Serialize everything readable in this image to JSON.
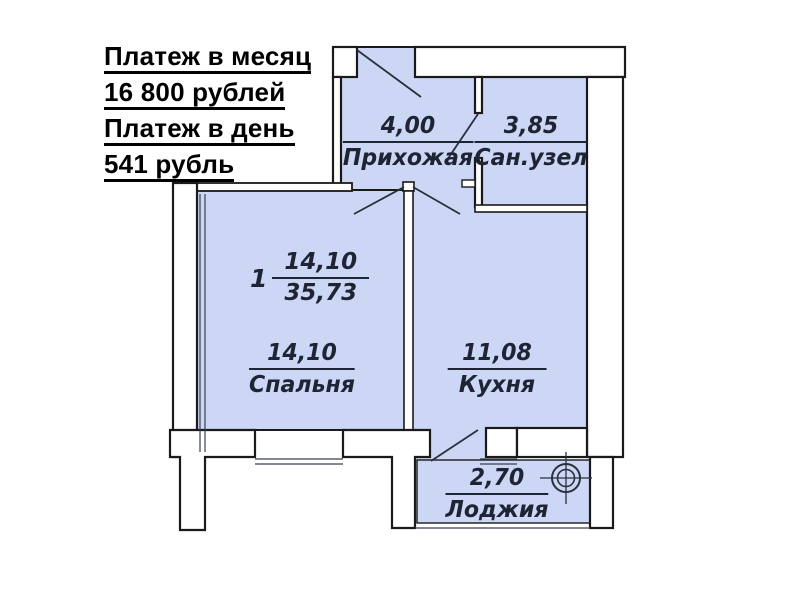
{
  "payment": {
    "lines": [
      "Платеж в месяц",
      "16 800 рублей",
      "Платеж в день",
      "541 рубль"
    ]
  },
  "apartment_summary": {
    "rooms": "1",
    "living_area": "14,10",
    "total_area": "35,73"
  },
  "rooms": [
    {
      "id": "hallway",
      "name": "Прихожая",
      "area": "4,00"
    },
    {
      "id": "bathroom",
      "name": "Сан.узел",
      "area": "3,85"
    },
    {
      "id": "bedroom",
      "name": "Спальня",
      "area": "14,10"
    },
    {
      "id": "kitchen",
      "name": "Кухня",
      "area": "11,08"
    },
    {
      "id": "loggia",
      "name": "Лоджия",
      "area": "2,70"
    }
  ],
  "icons": {
    "loggia_mark": "column-axis-mark"
  },
  "colors": {
    "room_fill": "#ccd7f5",
    "wall_fill": "#ffffff",
    "line": "#1a1a1a",
    "label_text": "#1e2433",
    "payment_text": "#000000",
    "background": "#ffffff"
  }
}
